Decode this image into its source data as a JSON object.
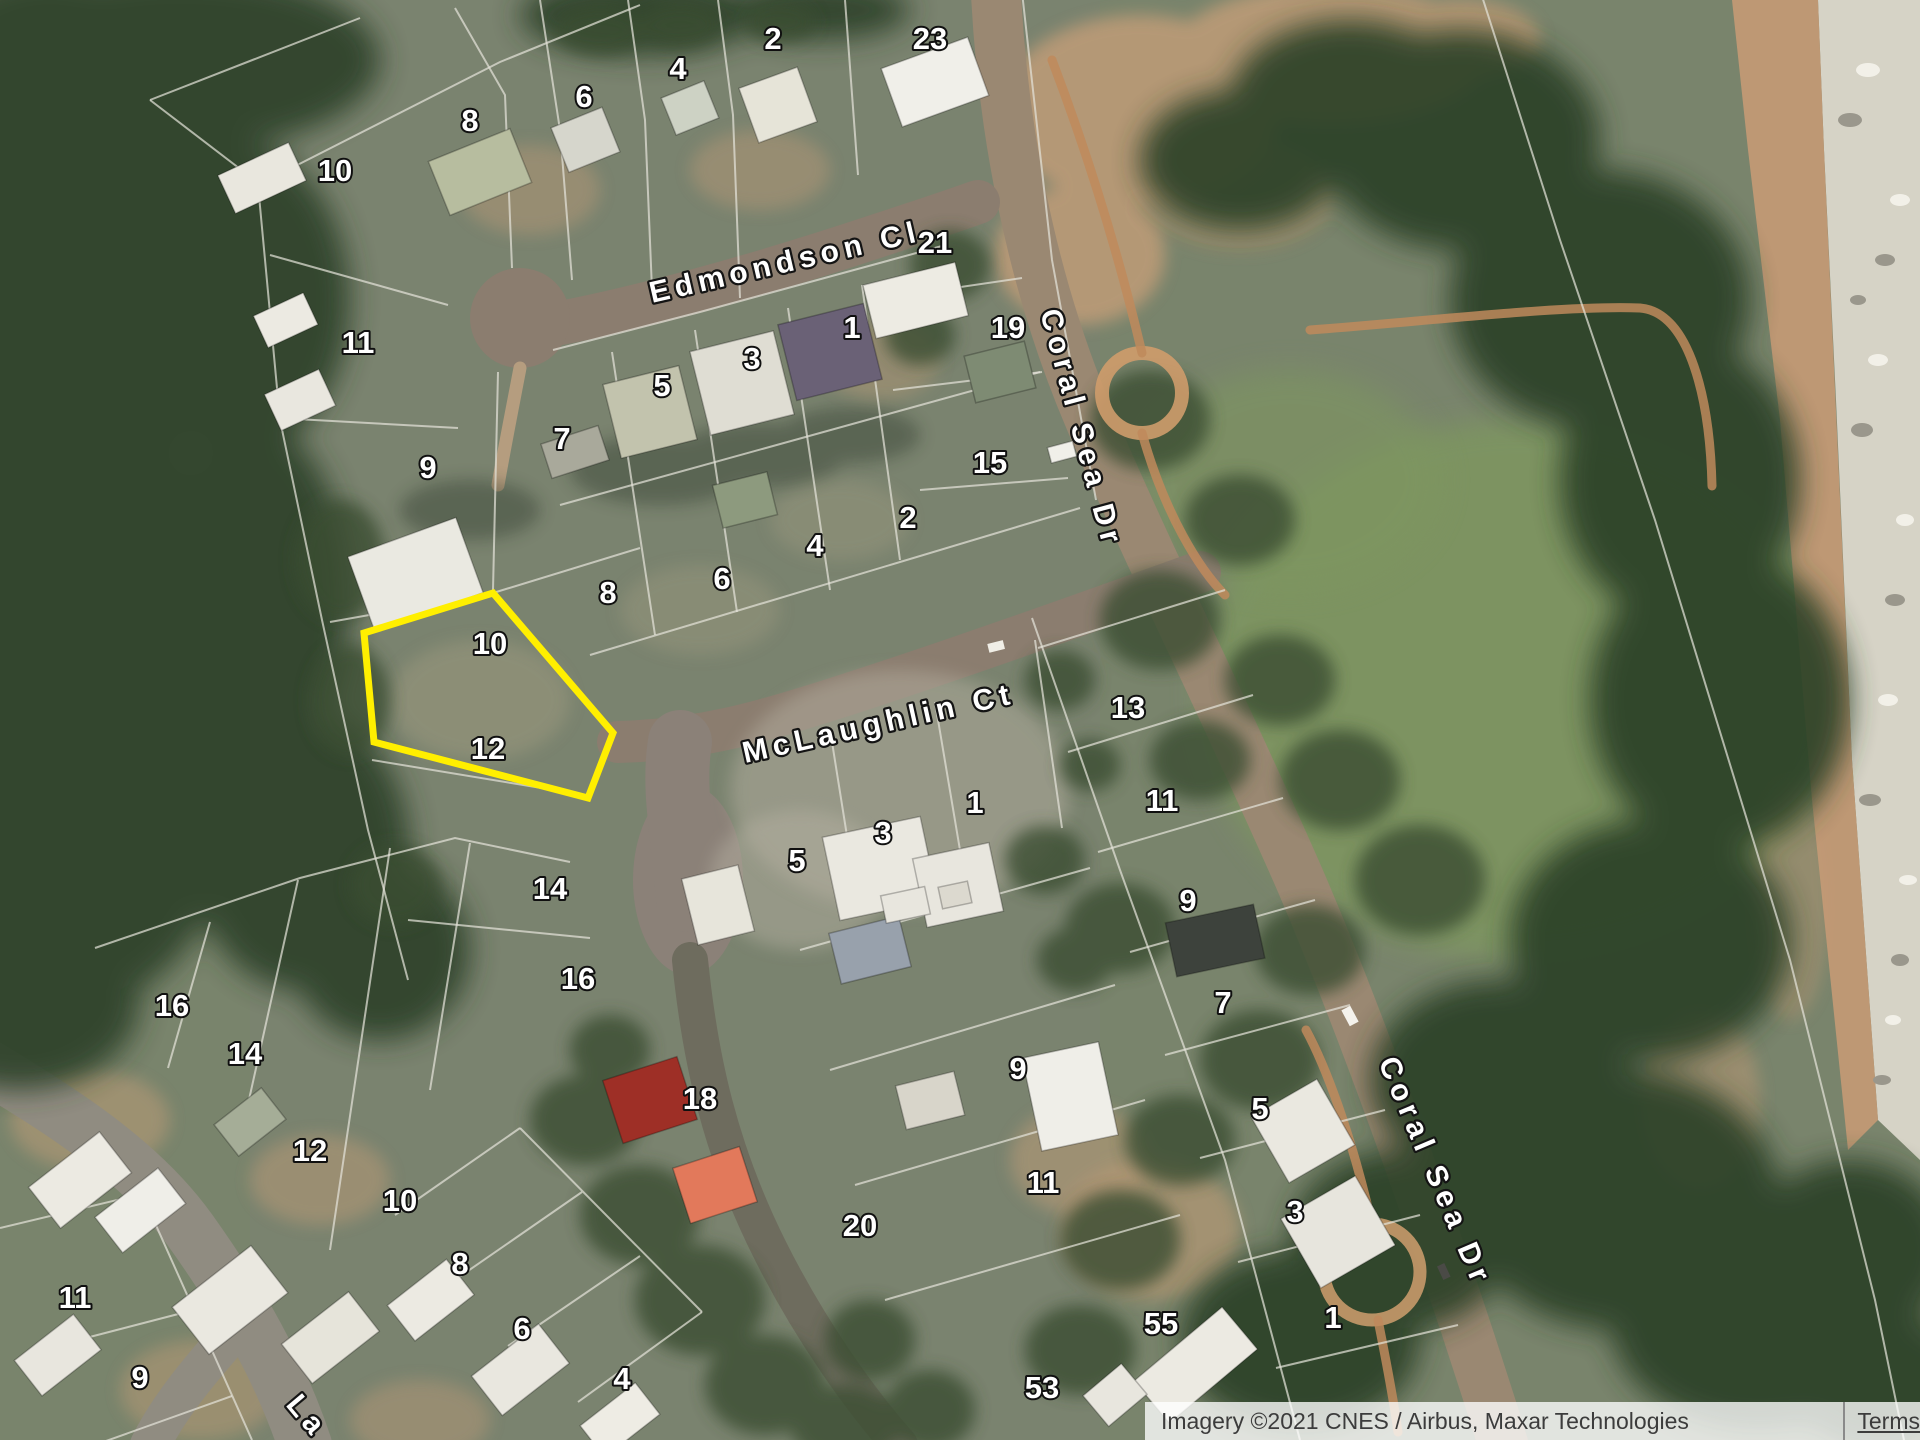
{
  "map": {
    "street_labels": [
      {
        "text": "Edmondson Cl",
        "x": 652,
        "y": 303,
        "rot": -13
      },
      {
        "text": "McLaughlin Ct",
        "x": 745,
        "y": 763,
        "rot": -12.5
      },
      {
        "text": "Coral Sea Dr",
        "x": 1040,
        "y": 312,
        "rot": 75
      },
      {
        "text": "Coral Sea Dr",
        "x": 1378,
        "y": 1062,
        "rot": 67
      },
      {
        "text": "La",
        "x": 285,
        "y": 1405,
        "rot": 50
      }
    ],
    "lot_labels": [
      {
        "t": "10",
        "x": 335,
        "y": 170
      },
      {
        "t": "8",
        "x": 470,
        "y": 120
      },
      {
        "t": "6",
        "x": 584,
        "y": 96
      },
      {
        "t": "4",
        "x": 678,
        "y": 68
      },
      {
        "t": "2",
        "x": 773,
        "y": 38
      },
      {
        "t": "23",
        "x": 930,
        "y": 38
      },
      {
        "t": "11",
        "x": 358,
        "y": 342
      },
      {
        "t": "9",
        "x": 428,
        "y": 467
      },
      {
        "t": "7",
        "x": 562,
        "y": 438
      },
      {
        "t": "5",
        "x": 662,
        "y": 385
      },
      {
        "t": "3",
        "x": 752,
        "y": 358
      },
      {
        "t": "1",
        "x": 852,
        "y": 327
      },
      {
        "t": "21",
        "x": 935,
        "y": 242
      },
      {
        "t": "19",
        "x": 1008,
        "y": 327
      },
      {
        "t": "15",
        "x": 990,
        "y": 462
      },
      {
        "t": "8",
        "x": 608,
        "y": 592
      },
      {
        "t": "6",
        "x": 722,
        "y": 578
      },
      {
        "t": "4",
        "x": 815,
        "y": 545
      },
      {
        "t": "2",
        "x": 908,
        "y": 517
      },
      {
        "t": "10",
        "x": 490,
        "y": 643
      },
      {
        "t": "12",
        "x": 488,
        "y": 748
      },
      {
        "t": "14",
        "x": 550,
        "y": 888
      },
      {
        "t": "16",
        "x": 578,
        "y": 978
      },
      {
        "t": "5",
        "x": 797,
        "y": 860
      },
      {
        "t": "3",
        "x": 883,
        "y": 832
      },
      {
        "t": "1",
        "x": 975,
        "y": 802
      },
      {
        "t": "18",
        "x": 700,
        "y": 1098
      },
      {
        "t": "20",
        "x": 860,
        "y": 1225
      },
      {
        "t": "9",
        "x": 1018,
        "y": 1068
      },
      {
        "t": "11",
        "x": 1043,
        "y": 1182
      },
      {
        "t": "13",
        "x": 1128,
        "y": 707
      },
      {
        "t": "11",
        "x": 1162,
        "y": 800
      },
      {
        "t": "9",
        "x": 1188,
        "y": 900
      },
      {
        "t": "7",
        "x": 1223,
        "y": 1002
      },
      {
        "t": "5",
        "x": 1260,
        "y": 1108
      },
      {
        "t": "3",
        "x": 1295,
        "y": 1211
      },
      {
        "t": "1",
        "x": 1333,
        "y": 1317
      },
      {
        "t": "16",
        "x": 172,
        "y": 1005
      },
      {
        "t": "14",
        "x": 245,
        "y": 1053
      },
      {
        "t": "12",
        "x": 310,
        "y": 1150
      },
      {
        "t": "10",
        "x": 400,
        "y": 1200
      },
      {
        "t": "8",
        "x": 460,
        "y": 1263
      },
      {
        "t": "6",
        "x": 522,
        "y": 1328
      },
      {
        "t": "4",
        "x": 622,
        "y": 1378
      },
      {
        "t": "11",
        "x": 75,
        "y": 1297
      },
      {
        "t": "9",
        "x": 140,
        "y": 1377
      },
      {
        "t": "55",
        "x": 1161,
        "y": 1323
      },
      {
        "t": "53",
        "x": 1042,
        "y": 1387
      }
    ],
    "highlight": {
      "points": "493,593 613,733 588,798 374,742 364,633",
      "color": "#ffef00"
    }
  },
  "attribution": {
    "imagery": "Imagery ©2021 CNES / Airbus, Maxar Technologies",
    "terms": "Terms"
  }
}
